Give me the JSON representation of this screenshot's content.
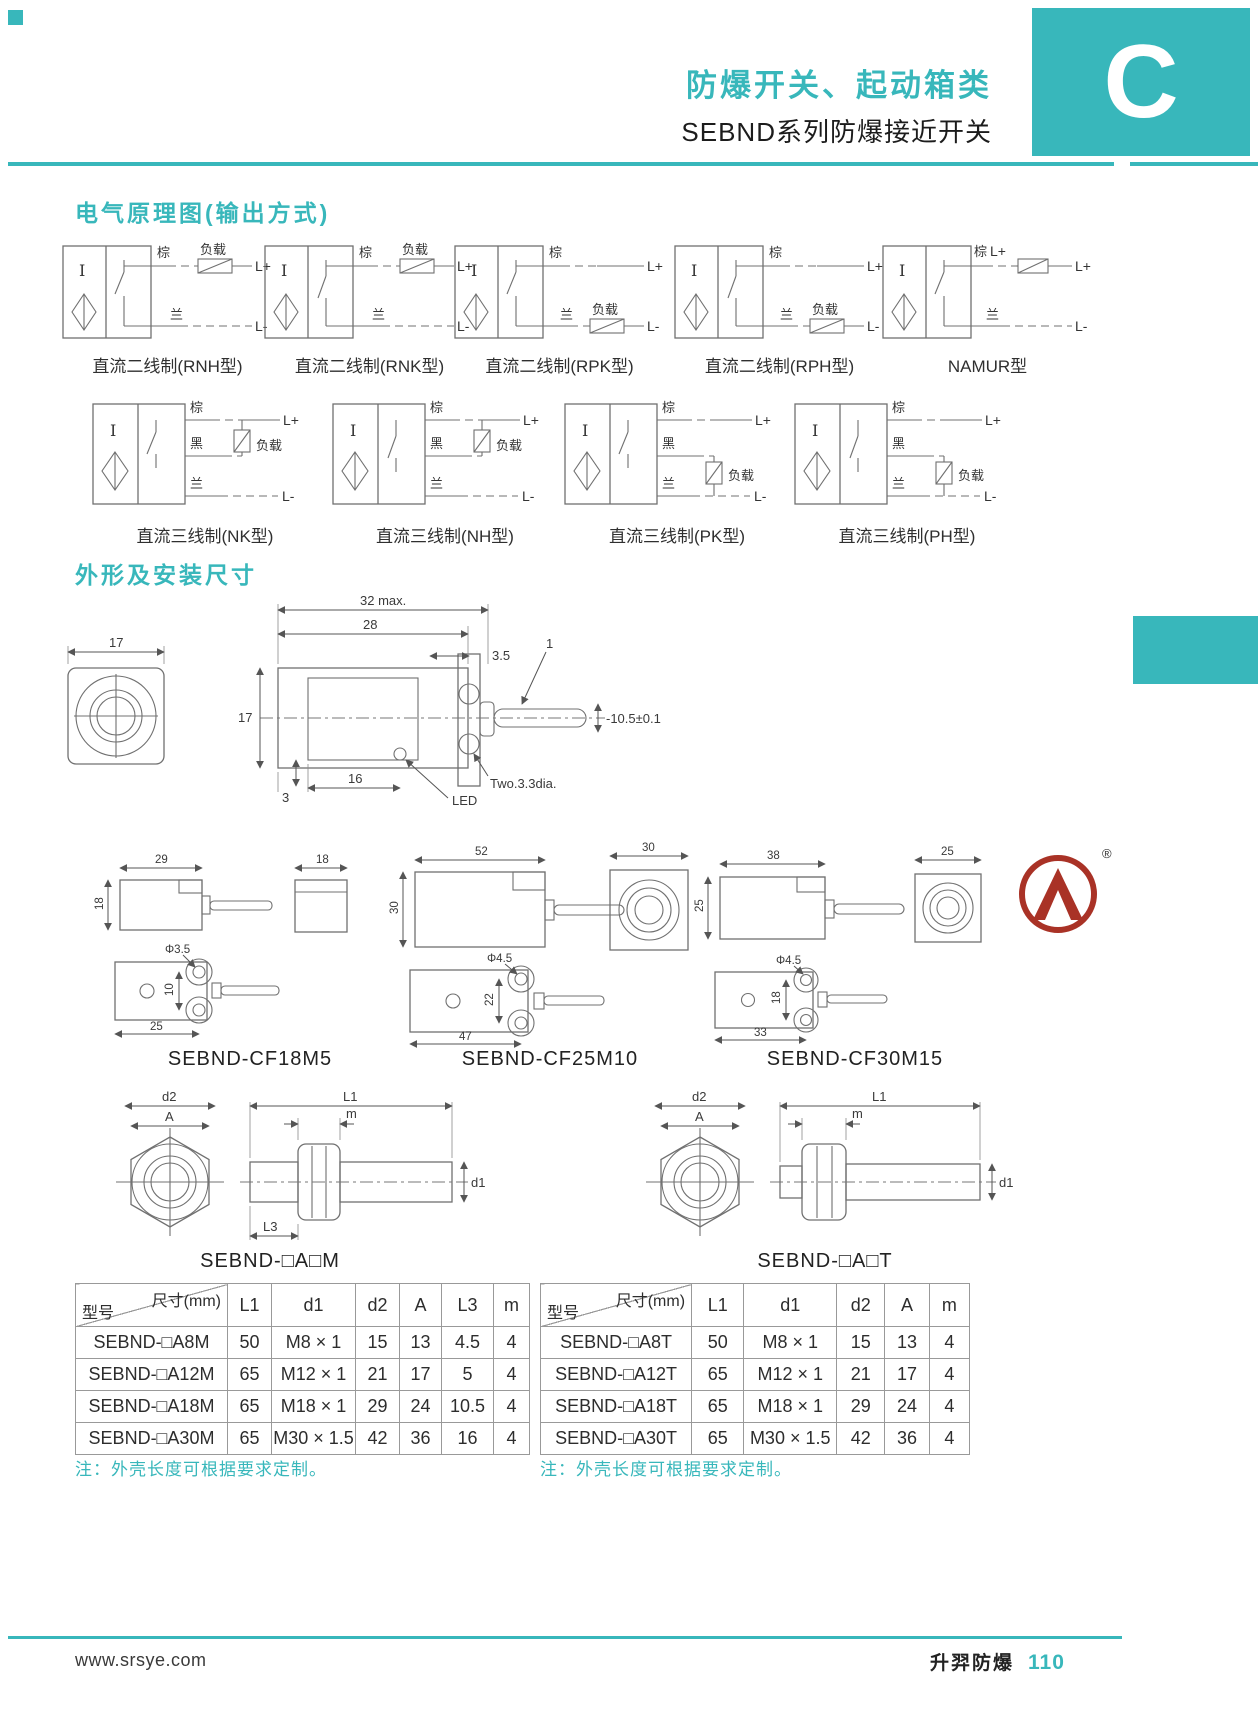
{
  "header": {
    "title": "防爆开关、起动箱类",
    "subtitle": "SEBND系列防爆接近开关",
    "chapter_letter": "C"
  },
  "sections": {
    "circuit_title": "电气原理图(输出方式)",
    "dimension_title": "外形及安装尺寸"
  },
  "wires": {
    "brown": "棕",
    "black": "黑",
    "blue": "兰",
    "load": "负载",
    "lp": "L+",
    "lm": "L-"
  },
  "circuits": {
    "row1": [
      {
        "label": "直流二线制(RNH型)"
      },
      {
        "label": "直流二线制(RNK型)"
      },
      {
        "label": "直流二线制(RPK型)"
      },
      {
        "label": "直流二线制(RPH型)"
      },
      {
        "label": "NAMUR型"
      }
    ],
    "row2": [
      {
        "label": "直流三线制(NK型)"
      },
      {
        "label": "直流三线制(NH型)"
      },
      {
        "label": "直流三线制(PK型)"
      },
      {
        "label": "直流三线制(PH型)"
      }
    ]
  },
  "main_drawing": {
    "face_w": "17",
    "total_w": "32 max.",
    "body_w": "28",
    "hole_off": "3.5",
    "height": "17",
    "cable_ref": "1",
    "cable_dim": "-10.5±0.1",
    "base_off": "3",
    "led_off": "16",
    "led": "LED",
    "holes": "Two.3.3dia."
  },
  "models": [
    {
      "name": "SEBND-CF18M5",
      "side_w": "29",
      "side_h": "18",
      "face_w": "18",
      "hole_dia": "Φ3.5",
      "hole_span": "10",
      "mount_w": "25"
    },
    {
      "name": "SEBND-CF25M10",
      "side_w": "52",
      "side_h": "30",
      "face_w": "30",
      "hole_dia": "Φ4.5",
      "hole_span": "22",
      "mount_w": "47"
    },
    {
      "name": "SEBND-CF30M15",
      "side_w": "38",
      "side_h": "25",
      "face_w": "25",
      "hole_dia": "Φ4.5",
      "hole_span": "18",
      "mount_w": "33"
    }
  ],
  "threaded": {
    "label_m": "SEBND-□A□M",
    "label_t": "SEBND-□A□T",
    "d2": "d2",
    "a": "A",
    "l1": "L1",
    "m": "m",
    "d1": "d1",
    "l3": "L3"
  },
  "tables": [
    {
      "corner_top": "尺寸(mm)",
      "corner_bottom": "型号",
      "headers": [
        "L1",
        "d1",
        "d2",
        "A",
        "L3",
        "m"
      ],
      "rows": [
        {
          "model": "SEBND-□A8M",
          "values": [
            "50",
            "M8 × 1",
            "15",
            "13",
            "4.5",
            "4"
          ]
        },
        {
          "model": "SEBND-□A12M",
          "values": [
            "65",
            "M12 × 1",
            "21",
            "17",
            "5",
            "4"
          ]
        },
        {
          "model": "SEBND-□A18M",
          "values": [
            "65",
            "M18 × 1",
            "29",
            "24",
            "10.5",
            "4"
          ]
        },
        {
          "model": "SEBND-□A30M",
          "values": [
            "65",
            "M30 × 1.5",
            "42",
            "36",
            "16",
            "4"
          ]
        }
      ],
      "note": "注：外壳长度可根据要求定制。"
    },
    {
      "corner_top": "尺寸(mm)",
      "corner_bottom": "型号",
      "headers": [
        "L1",
        "d1",
        "d2",
        "A",
        "m"
      ],
      "rows": [
        {
          "model": "SEBND-□A8T",
          "values": [
            "50",
            "M8 × 1",
            "15",
            "13",
            "4"
          ]
        },
        {
          "model": "SEBND-□A12T",
          "values": [
            "65",
            "M12 × 1",
            "21",
            "17",
            "4"
          ]
        },
        {
          "model": "SEBND-□A18T",
          "values": [
            "65",
            "M18 × 1",
            "29",
            "24",
            "4"
          ]
        },
        {
          "model": "SEBND-□A30T",
          "values": [
            "65",
            "M30 × 1.5",
            "42",
            "36",
            "4"
          ]
        }
      ],
      "note": "注：外壳长度可根据要求定制。"
    }
  ],
  "logo": {
    "registered": "®"
  },
  "footer": {
    "website": "www.srsye.com",
    "brand": "升羿防爆",
    "page_number": "110"
  }
}
